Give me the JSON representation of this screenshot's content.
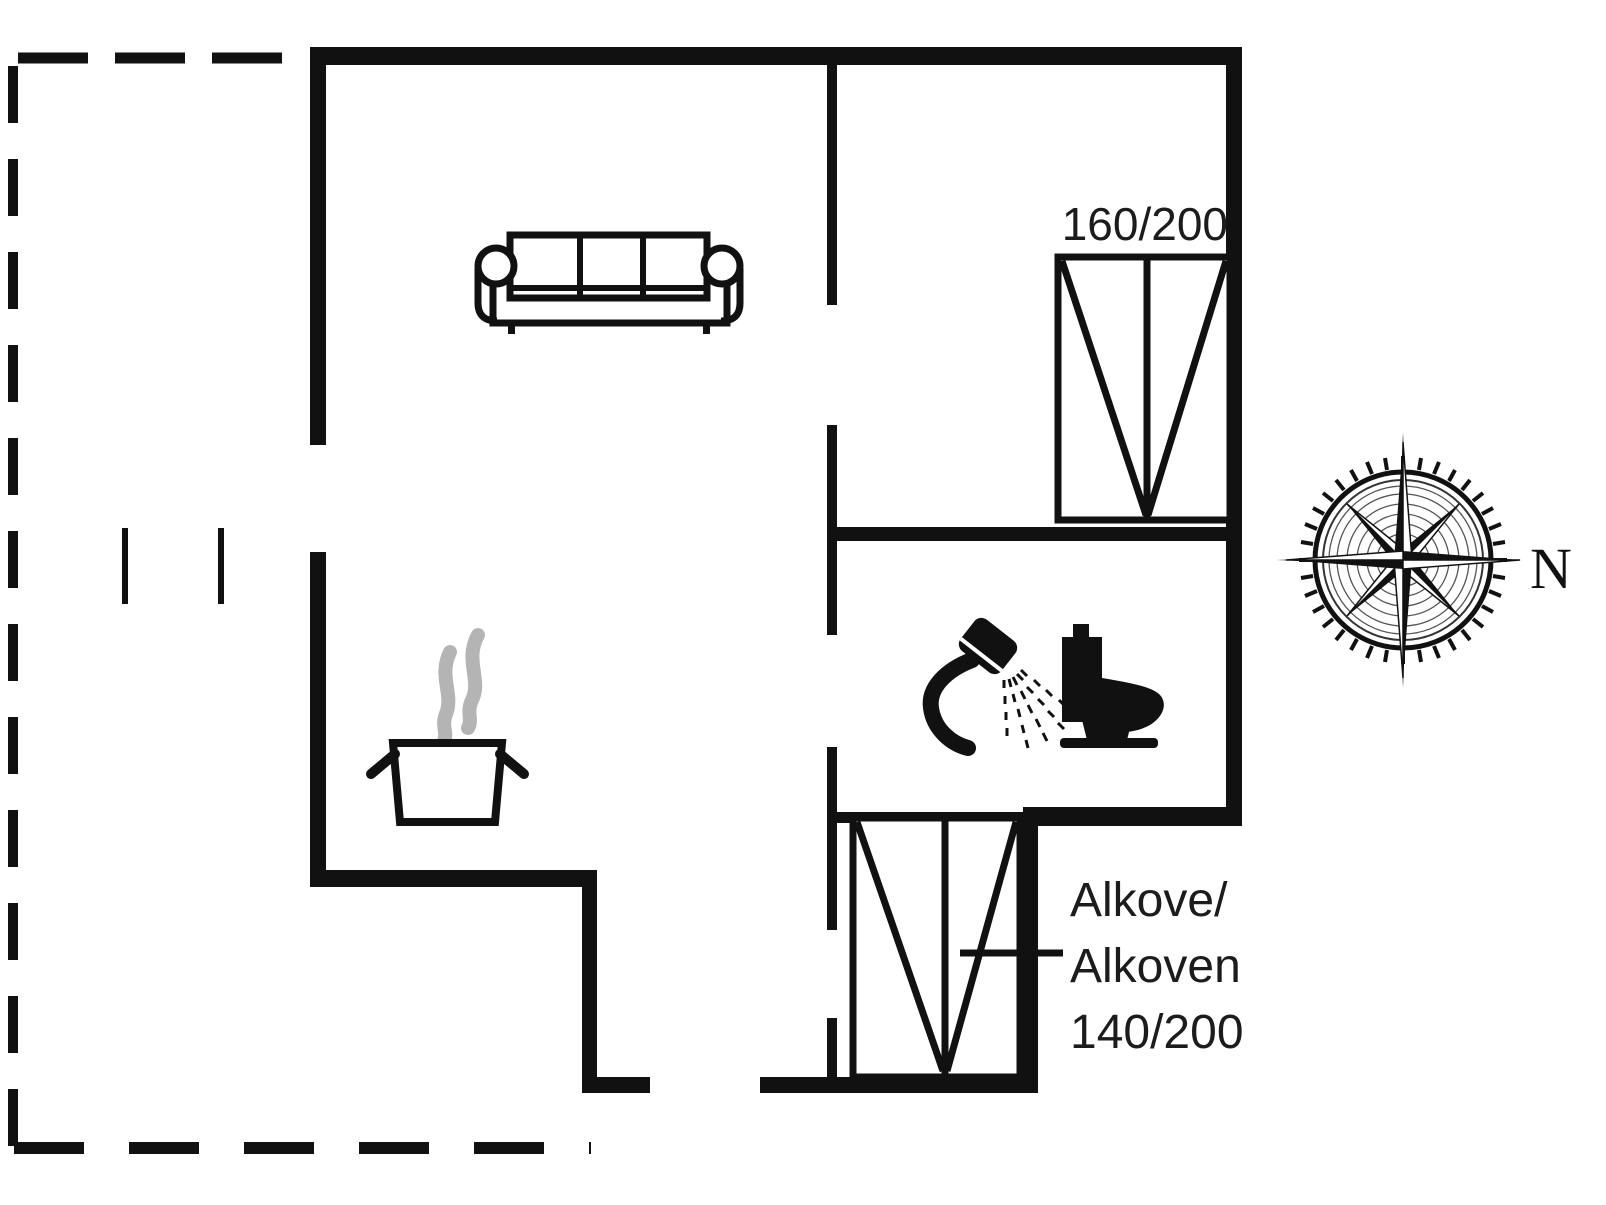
{
  "title": "Holiday house floor plan",
  "colors": {
    "ink": "#111111",
    "wall": "#111111",
    "steam_gray": "#b4b4b4",
    "background": "#ffffff",
    "text": "#1c1c1c"
  },
  "labels": {
    "bedroom_bed_size": "160/200",
    "alcove_line1": "Alkove/",
    "alcove_line2": "Alkoven",
    "alcove_line3": "140/200",
    "compass_north": "N"
  },
  "icons": {
    "sofa-icon": "svg-shape",
    "cooking-pot-icon": "svg-shape",
    "steam-icon": "svg-shape",
    "shower-icon": "svg-shape",
    "toilet-icon": "svg-shape",
    "double-bed-icon": "svg-shape",
    "alcove-bed-icon": "svg-shape",
    "compass-rose-icon": "svg-shape",
    "terrace-dashed-outline": "svg-shape"
  }
}
